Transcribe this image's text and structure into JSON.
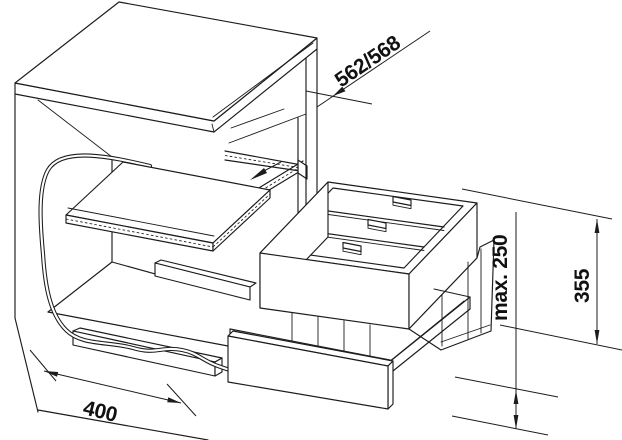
{
  "diagram": {
    "type": "technical-installation-drawing",
    "subject": "pull-out waste separation unit in kitchen base cabinet",
    "dimensions": {
      "cabinet_depth": "562/568",
      "front_panel_height": "max. 250",
      "system_height": "355",
      "cabinet_width": "400"
    },
    "colors": {
      "line": "#1c1c1c",
      "background": "#ffffff",
      "dimension_text": "#111111"
    },
    "parts": {
      "cabinet": "base cabinet with worktop",
      "board": "pull-out board",
      "cable": "flexible cable",
      "rails": "telescopic slide rails",
      "frame": "bin carrier frame with three lidded bins",
      "tray": "pull-out tray",
      "front_panel": "drawer front panel"
    }
  }
}
